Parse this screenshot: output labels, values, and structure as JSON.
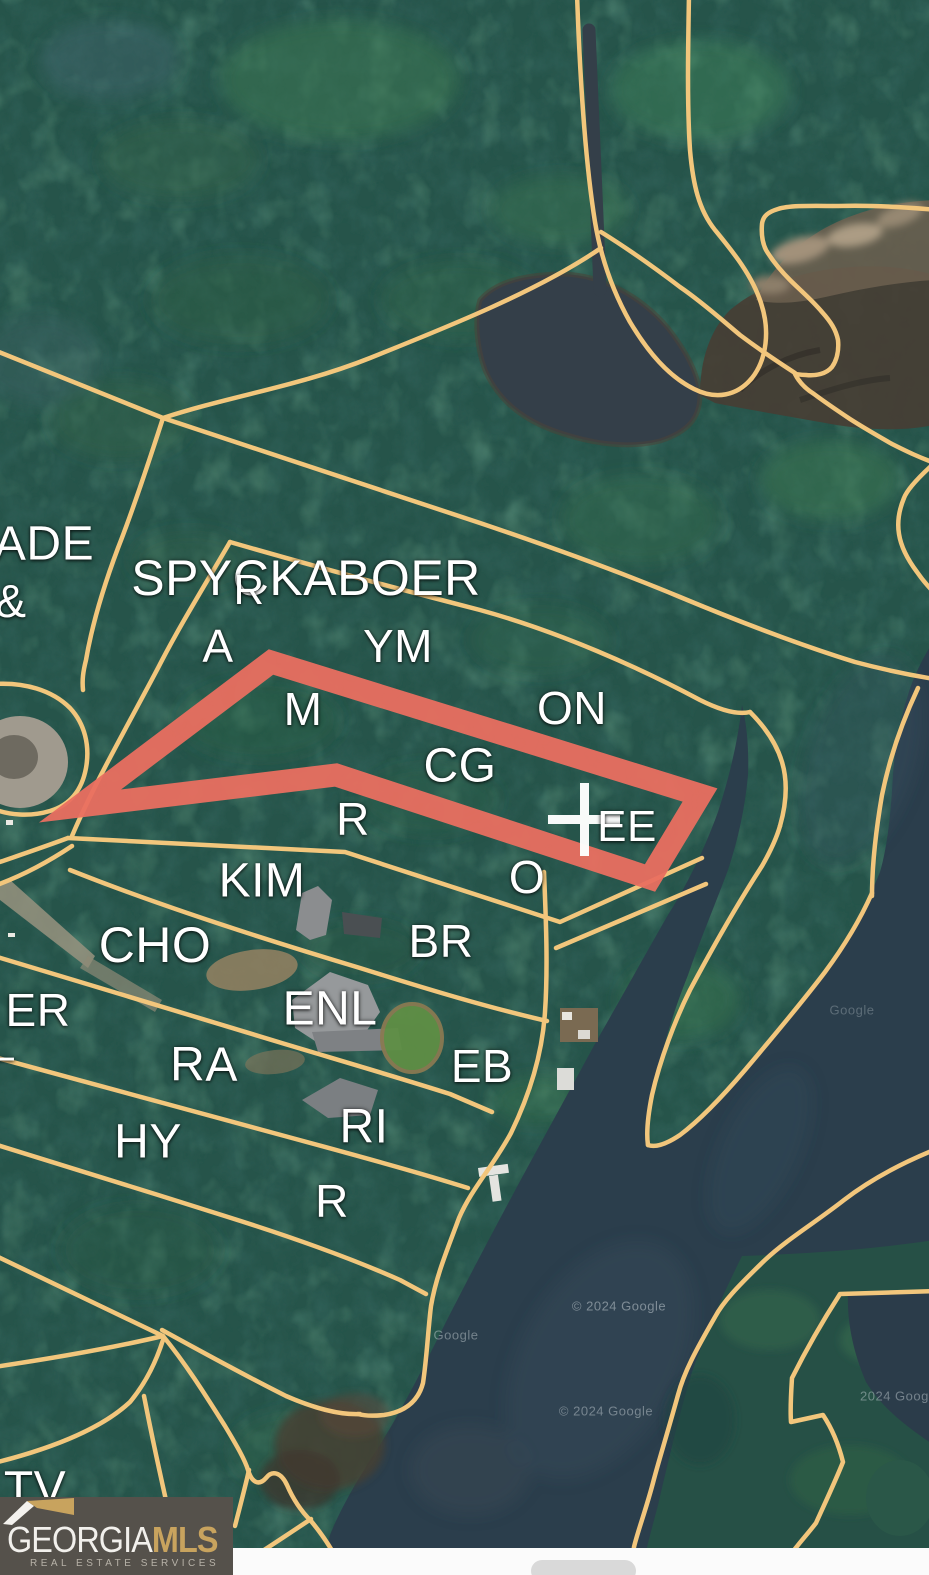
{
  "colors": {
    "boundary_line": "#f2c67c",
    "highlight_outline": "#e96f60",
    "label_text": "#ffffff",
    "forest_base": "#26544a",
    "water": "#2b3e4c",
    "logo_background": "#55514b",
    "logo_gold": "#c8a35e"
  },
  "map": {
    "labels": [
      {
        "text": "ADE",
        "x": 44,
        "y": 544,
        "size": 48
      },
      {
        "text": "&",
        "x": 11,
        "y": 601,
        "size": 46
      },
      {
        "text": "SPYCKABOER",
        "x": 306,
        "y": 578,
        "size": 50
      },
      {
        "text": "R",
        "x": 249,
        "y": 590,
        "size": 42
      },
      {
        "text": "A",
        "x": 218,
        "y": 646,
        "size": 46
      },
      {
        "text": "YM",
        "x": 398,
        "y": 646,
        "size": 46
      },
      {
        "text": "M",
        "x": 303,
        "y": 709,
        "size": 46
      },
      {
        "text": "ON",
        "x": 572,
        "y": 708,
        "size": 46
      },
      {
        "text": "CG",
        "x": 460,
        "y": 766,
        "size": 48
      },
      {
        "text": "R",
        "x": 353,
        "y": 819,
        "size": 46
      },
      {
        "text": "EE",
        "x": 627,
        "y": 827,
        "size": 44
      },
      {
        "text": "O",
        "x": 527,
        "y": 877,
        "size": 46
      },
      {
        "text": "KIM",
        "x": 262,
        "y": 881,
        "size": 48
      },
      {
        "text": "CHO",
        "x": 155,
        "y": 945,
        "size": 50
      },
      {
        "text": "BR",
        "x": 441,
        "y": 941,
        "size": 46
      },
      {
        "text": "ENL",
        "x": 330,
        "y": 1009,
        "size": 48
      },
      {
        "text": "ER",
        "x": 38,
        "y": 1010,
        "size": 46
      },
      {
        "text": "RA",
        "x": 204,
        "y": 1065,
        "size": 48
      },
      {
        "text": "EB",
        "x": 482,
        "y": 1066,
        "size": 46
      },
      {
        "text": "RI",
        "x": 364,
        "y": 1127,
        "size": 48
      },
      {
        "text": "HY",
        "x": 148,
        "y": 1142,
        "size": 48
      },
      {
        "text": "R",
        "x": 332,
        "y": 1201,
        "size": 46
      },
      {
        "text": "–",
        "x": 2,
        "y": 1056,
        "size": 44
      },
      {
        "text": "TV",
        "x": 35,
        "y": 1489,
        "size": 48
      }
    ],
    "watermarks": [
      {
        "text": "Google",
        "x": 456,
        "y": 1335,
        "opacity": 0.45
      },
      {
        "text": "© 2024 Google",
        "x": 619,
        "y": 1306,
        "opacity": 0.5
      },
      {
        "text": "© 2024 Google",
        "x": 606,
        "y": 1411,
        "opacity": 0.45
      },
      {
        "text": "2024 Google",
        "x": 900,
        "y": 1396,
        "opacity": 0.45
      },
      {
        "text": "Google",
        "x": 852,
        "y": 1010,
        "opacity": 0.3
      }
    ]
  },
  "logo": {
    "brand_primary": "GEORGIA",
    "brand_secondary": "MLS",
    "tagline": "REAL ESTATE SERVICES"
  }
}
